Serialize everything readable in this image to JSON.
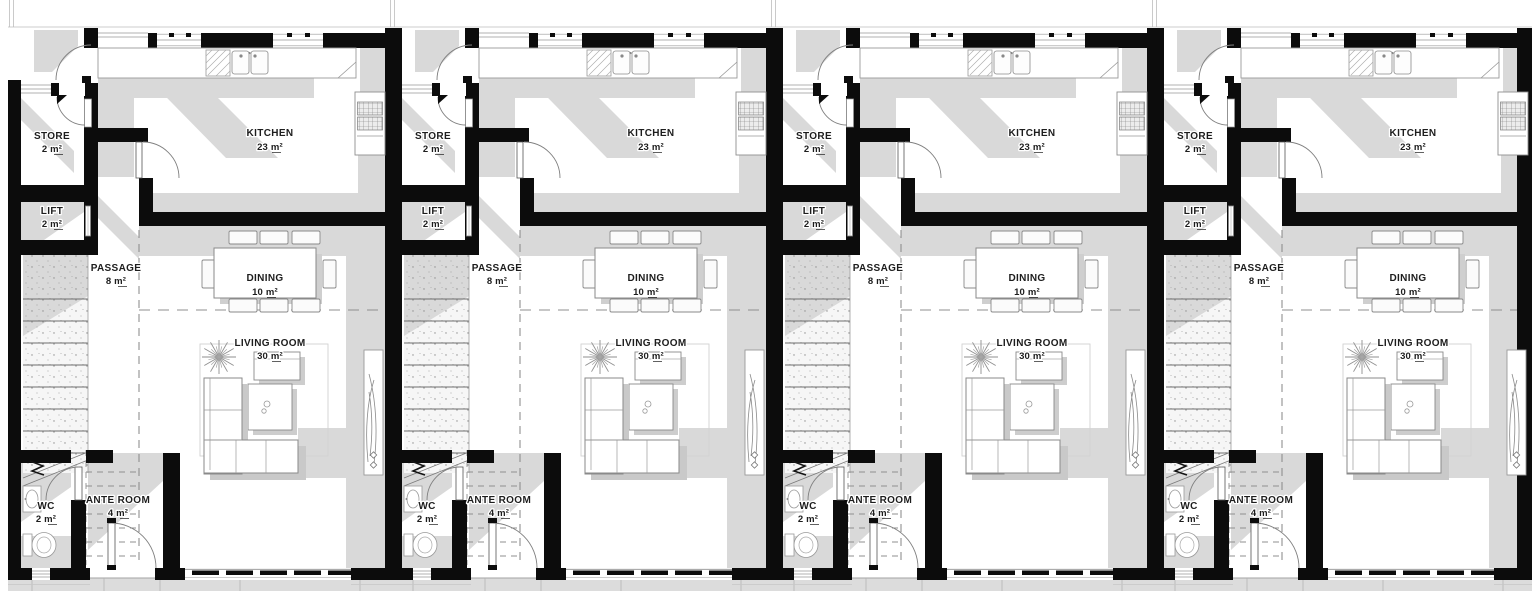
{
  "unit_count": 4,
  "unit": {
    "rooms": {
      "store": {
        "name": "STORE",
        "area": "2 m²"
      },
      "kitchen": {
        "name": "KITCHEN",
        "area": "23 m²"
      },
      "lift": {
        "name": "LIFT",
        "area": "2 m²"
      },
      "passage": {
        "name": "PASSAGE",
        "area": "8 m²"
      },
      "dining": {
        "name": "DINING",
        "area": "10 m²"
      },
      "living_room": {
        "name": "LIVING ROOM",
        "area": "30 m²"
      },
      "wc": {
        "name": "WC",
        "area": "2 m²"
      },
      "ante_room": {
        "name": "ANTE ROOM",
        "area": "4 m²"
      }
    }
  },
  "colors": {
    "wall": "#0c0c0c",
    "shadow": "#d9d9d9",
    "paving": "#dcdcdc",
    "line": "#8a8a8a",
    "text": "#1d1d1d",
    "floor": "#ffffff"
  }
}
